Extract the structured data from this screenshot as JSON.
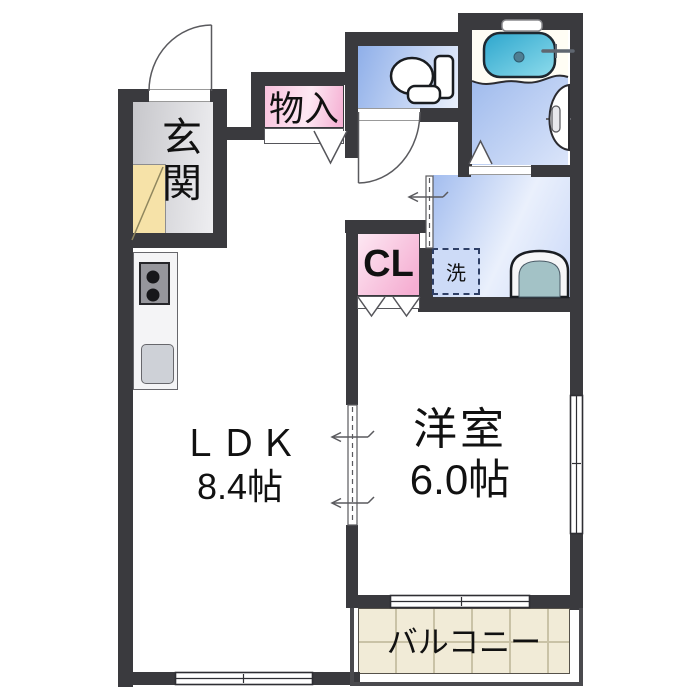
{
  "page": {
    "type": "apartment-floor-plan",
    "background": "#ffffff"
  },
  "rooms": {
    "genkan": {
      "label": "玄関"
    },
    "storage": {
      "label": "物入"
    },
    "closet": {
      "label": "CL"
    },
    "washroom": {
      "washer_label": "洗"
    },
    "ldk": {
      "label": "ＬＤＫ",
      "size": "8.4帖"
    },
    "western_room": {
      "label": "洋室",
      "size": "6.0帖"
    },
    "balcony": {
      "label": "バルコニー"
    }
  },
  "icons": [
    "bathtub-icon",
    "bath-faucet-icon",
    "bath-window",
    "bath-door",
    "toilet-icon",
    "washbasin-icon",
    "washing-machine-space",
    "stove-icon",
    "kitchen-sink-icon",
    "kitchen-counter",
    "shoe-cabinet-icon",
    "entrance-door-swing",
    "toilet-door-swing",
    "folding-door-marks",
    "sliding-door-arrows",
    "window-symbols"
  ],
  "colors": {
    "wall": "#3a3a3e",
    "door_line": "#5a5a5e",
    "pink_deep": "#f5aed2",
    "pink_light": "#fde8f3",
    "blue_deep": "#8fafe9",
    "blue_light": "#eaf0fc",
    "tub_deep": "#2da6cd",
    "tub_light": "#8edcec",
    "balcony_floor": "#f1ebd7",
    "balcony_grid": "#c9c2a6",
    "genkan_floor": "#c7c7cb",
    "genkan_floor_light": "#eeeef1",
    "shoe_cabinet": "#f6e2a8",
    "stove_top": "#96969c",
    "kitchen_sink": "#ced1d7",
    "text": "#111111"
  }
}
